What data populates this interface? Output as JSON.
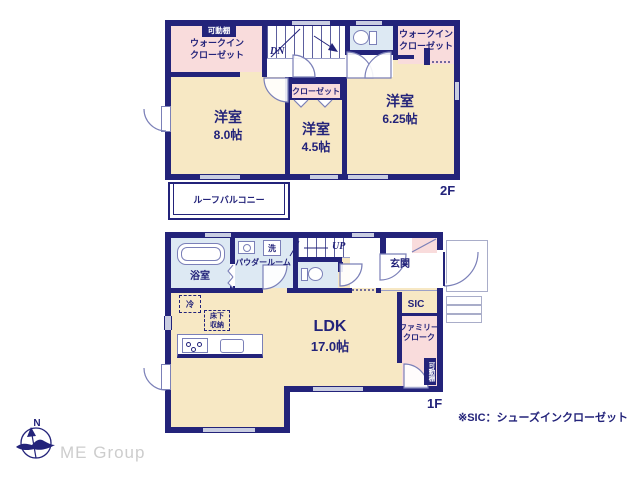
{
  "floor2": {
    "label": "2F",
    "wic_left": {
      "shelf": "可動棚",
      "name": "ウォークイン\nクローゼット"
    },
    "stairs": {
      "label": "DN"
    },
    "wic_right": {
      "name": "ウォークイン\nクローゼット"
    },
    "room_a": {
      "name": "洋室",
      "size": "8.0帖"
    },
    "closet": {
      "name": "クローゼット"
    },
    "room_b": {
      "name": "洋室",
      "size": "4.5帖"
    },
    "room_c": {
      "name": "洋室",
      "size": "6.25帖"
    },
    "balcony": {
      "name": "ルーフバルコニー"
    }
  },
  "floor1": {
    "label": "1F",
    "bath": {
      "name": "浴室"
    },
    "powder": {
      "name": "パウダールーム",
      "laundry": "洗"
    },
    "stairs": {
      "label": "UP"
    },
    "entrance": {
      "name": "玄関"
    },
    "sic": {
      "name": "SIC"
    },
    "family_closet": {
      "name": "ファミリー\nクローク",
      "shelf": "可動棚"
    },
    "fridge": "冷",
    "underfloor": "床下\n収納",
    "ldk": {
      "name": "LDK",
      "size": "17.0帖"
    }
  },
  "footer": {
    "note": "※SIC：シューズインクローゼット",
    "brand": "ME Group",
    "compass_n": "N"
  },
  "colors": {
    "wall": "#23237a",
    "room": "#f7e8c4",
    "closet_area": "#f9dcdc",
    "wet_area": "#dde9f3",
    "window": "#c9cde1",
    "brand_gray": "#cdcdcd"
  }
}
